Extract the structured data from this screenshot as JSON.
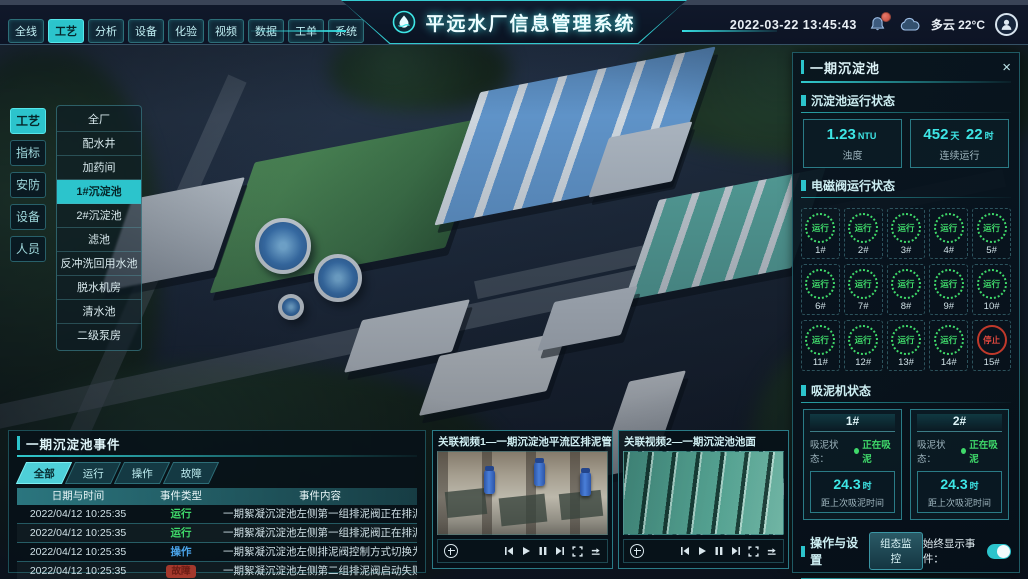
{
  "colors": {
    "accent": "#35dce0",
    "green": "#3fd96a",
    "red": "#e0483f",
    "blue": "#4aa3e8"
  },
  "header": {
    "title": "平远水厂信息管理系统",
    "datetime": "2022-03-22 13:45:43",
    "weather": "多云 22°C",
    "nav_tabs": [
      {
        "label": "全线",
        "active": false
      },
      {
        "label": "工艺",
        "active": true
      },
      {
        "label": "分析",
        "active": false
      },
      {
        "label": "设备",
        "active": false
      },
      {
        "label": "化验",
        "active": false
      },
      {
        "label": "视频",
        "active": false
      },
      {
        "label": "数据",
        "active": false
      },
      {
        "label": "工单",
        "active": false
      },
      {
        "label": "系统",
        "active": false
      }
    ],
    "icons": [
      "water-drop-logo-icon",
      "bell-icon",
      "bell-badge",
      "cloud-icon",
      "user-avatar-icon"
    ]
  },
  "left_tabs": [
    {
      "label": "工艺",
      "active": true
    },
    {
      "label": "指标",
      "active": false
    },
    {
      "label": "安防",
      "active": false
    },
    {
      "label": "设备",
      "active": false
    },
    {
      "label": "人员",
      "active": false
    }
  ],
  "left_menu": {
    "items": [
      {
        "label": "全厂",
        "active": false
      },
      {
        "label": "配水井",
        "active": false
      },
      {
        "label": "加药间",
        "active": false
      },
      {
        "label": "1#沉淀池",
        "active": true
      },
      {
        "label": "2#沉淀池",
        "active": false
      },
      {
        "label": "滤池",
        "active": false
      },
      {
        "label": "反冲洗回用水池",
        "active": false
      },
      {
        "label": "脱水机房",
        "active": false
      },
      {
        "label": "清水池",
        "active": false
      },
      {
        "label": "二级泵房",
        "active": false
      }
    ]
  },
  "right_panel": {
    "title": "一期沉淀池",
    "close_label": "×",
    "running_status": {
      "title": "沉淀池运行状态",
      "stats": [
        {
          "value": "1.23",
          "unit": "NTU",
          "label": "浊度"
        },
        {
          "parts": [
            {
              "v": "452",
              "u": "天"
            },
            {
              "v": "22",
              "u": "时"
            }
          ],
          "label": "连续运行"
        }
      ]
    },
    "valves": {
      "title": "电磁阀运行状态",
      "items": [
        {
          "id": "1#",
          "status": "运行",
          "state": "run"
        },
        {
          "id": "2#",
          "status": "运行",
          "state": "run"
        },
        {
          "id": "3#",
          "status": "运行",
          "state": "run"
        },
        {
          "id": "4#",
          "status": "运行",
          "state": "run"
        },
        {
          "id": "5#",
          "status": "运行",
          "state": "run"
        },
        {
          "id": "6#",
          "status": "运行",
          "state": "run"
        },
        {
          "id": "7#",
          "status": "运行",
          "state": "run"
        },
        {
          "id": "8#",
          "status": "运行",
          "state": "run"
        },
        {
          "id": "9#",
          "status": "运行",
          "state": "run"
        },
        {
          "id": "10#",
          "status": "运行",
          "state": "run"
        },
        {
          "id": "11#",
          "status": "运行",
          "state": "run"
        },
        {
          "id": "12#",
          "status": "运行",
          "state": "run"
        },
        {
          "id": "13#",
          "status": "运行",
          "state": "run"
        },
        {
          "id": "14#",
          "status": "运行",
          "state": "run"
        },
        {
          "id": "15#",
          "status": "停止",
          "state": "stop"
        }
      ]
    },
    "mud": {
      "title": "吸泥机状态",
      "machines": [
        {
          "id": "1#",
          "status_label": "吸泥状态：",
          "status": "正在吸泥",
          "value": "24.3",
          "unit": "时",
          "label": "距上次吸泥时间"
        },
        {
          "id": "2#",
          "status_label": "吸泥状态：",
          "status": "正在吸泥",
          "value": "24.3",
          "unit": "时",
          "label": "距上次吸泥时间"
        }
      ]
    },
    "ops": {
      "title": "操作与设置",
      "button": "组态监控",
      "toggle_label": "始终显示事件：",
      "toggle_on": true
    }
  },
  "events": {
    "title": "一期沉淀池事件",
    "tabs": [
      {
        "label": "全部",
        "active": true
      },
      {
        "label": "运行",
        "active": false
      },
      {
        "label": "操作",
        "active": false
      },
      {
        "label": "故障",
        "active": false
      }
    ],
    "columns": [
      "日期与时间",
      "事件类型",
      "事件内容"
    ],
    "rows": [
      {
        "datetime": "2022/04/12 10:25:35",
        "type": "运行",
        "type_color": "green",
        "content": "一期絮凝沉淀池左侧第一组排泥阀正在排泥"
      },
      {
        "datetime": "2022/04/12 10:25:35",
        "type": "运行",
        "type_color": "green",
        "content": "一期絮凝沉淀池左侧第一组排泥阀正在排泥"
      },
      {
        "datetime": "2022/04/12 10:25:35",
        "type": "操作",
        "type_color": "blue",
        "content": "一期絮凝沉淀池左侧排泥阀控制方式切换为手动"
      },
      {
        "datetime": "2022/04/12 10:25:35",
        "type": "故障",
        "type_color": "red",
        "content": "一期絮凝沉淀池左侧第二组排泥阀启动失败"
      }
    ]
  },
  "videos": [
    {
      "title": "关联视频1—一期沉淀池平流区排泥管廊",
      "controls": [
        "ptz-pad",
        "skip-back",
        "play",
        "pause",
        "skip-forward",
        "fullscreen",
        "loop"
      ]
    },
    {
      "title": "关联视频2—一期沉淀池池面",
      "controls": [
        "ptz-pad",
        "skip-back",
        "play",
        "pause",
        "skip-forward",
        "fullscreen",
        "loop"
      ]
    }
  ]
}
